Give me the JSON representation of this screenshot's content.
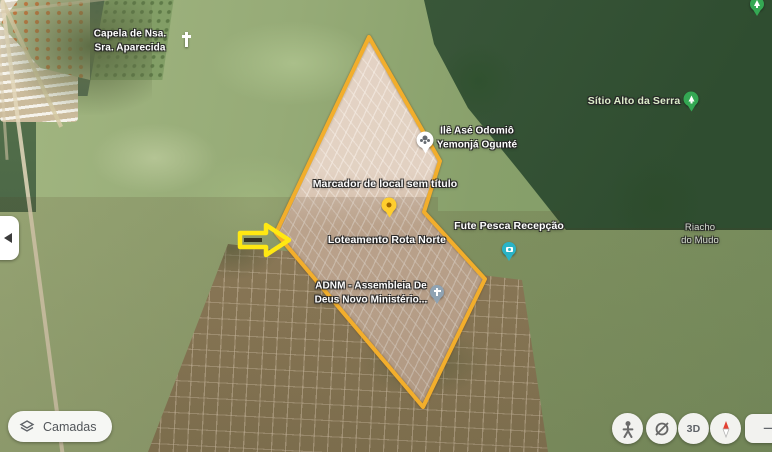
{
  "place_labels": {
    "capela": "Capela de Nsa.\nSra. Aparecida",
    "sitio_alto_da_serra": "Sítio Alto da Serra",
    "ile_ase": "Ilê Asé Odomiô\nYemonjá Ogunté",
    "marcador": "Marcador de local sem título",
    "loteamento": "Loteamento Rota Norte",
    "fute_pesca": "Fute Pesca Recepção",
    "adnm": "ADNM - Assembleia De\nDeus Novo Ministério...",
    "riacho": "Riacho\ndo Mudo"
  },
  "pins": {
    "ile_ase": {
      "kind": "white-place-pin",
      "color": "#ffffff"
    },
    "marcador": {
      "kind": "yellow-default-marker",
      "color": "#ffce2e",
      "dot_color": "#a06800"
    },
    "fute_pesca": {
      "kind": "photo-pin",
      "color": "#2ab3c6"
    },
    "adnm": {
      "kind": "church-pin",
      "color": "#8fa3b3"
    },
    "sitio_alto_da_serra": {
      "kind": "nature-pin",
      "color": "#34a853"
    },
    "top_edge": {
      "kind": "nature-pin",
      "color": "#34a853"
    },
    "capela": {
      "kind": "white-cross",
      "color": "#ffffff"
    }
  },
  "overlay": {
    "boundary_color": "#f2ae2c",
    "arrow_color": "#ffe812"
  },
  "controls": {
    "layers_label": "Camadas",
    "three_d_label": "3D",
    "zoom_out_glyph": "−"
  }
}
